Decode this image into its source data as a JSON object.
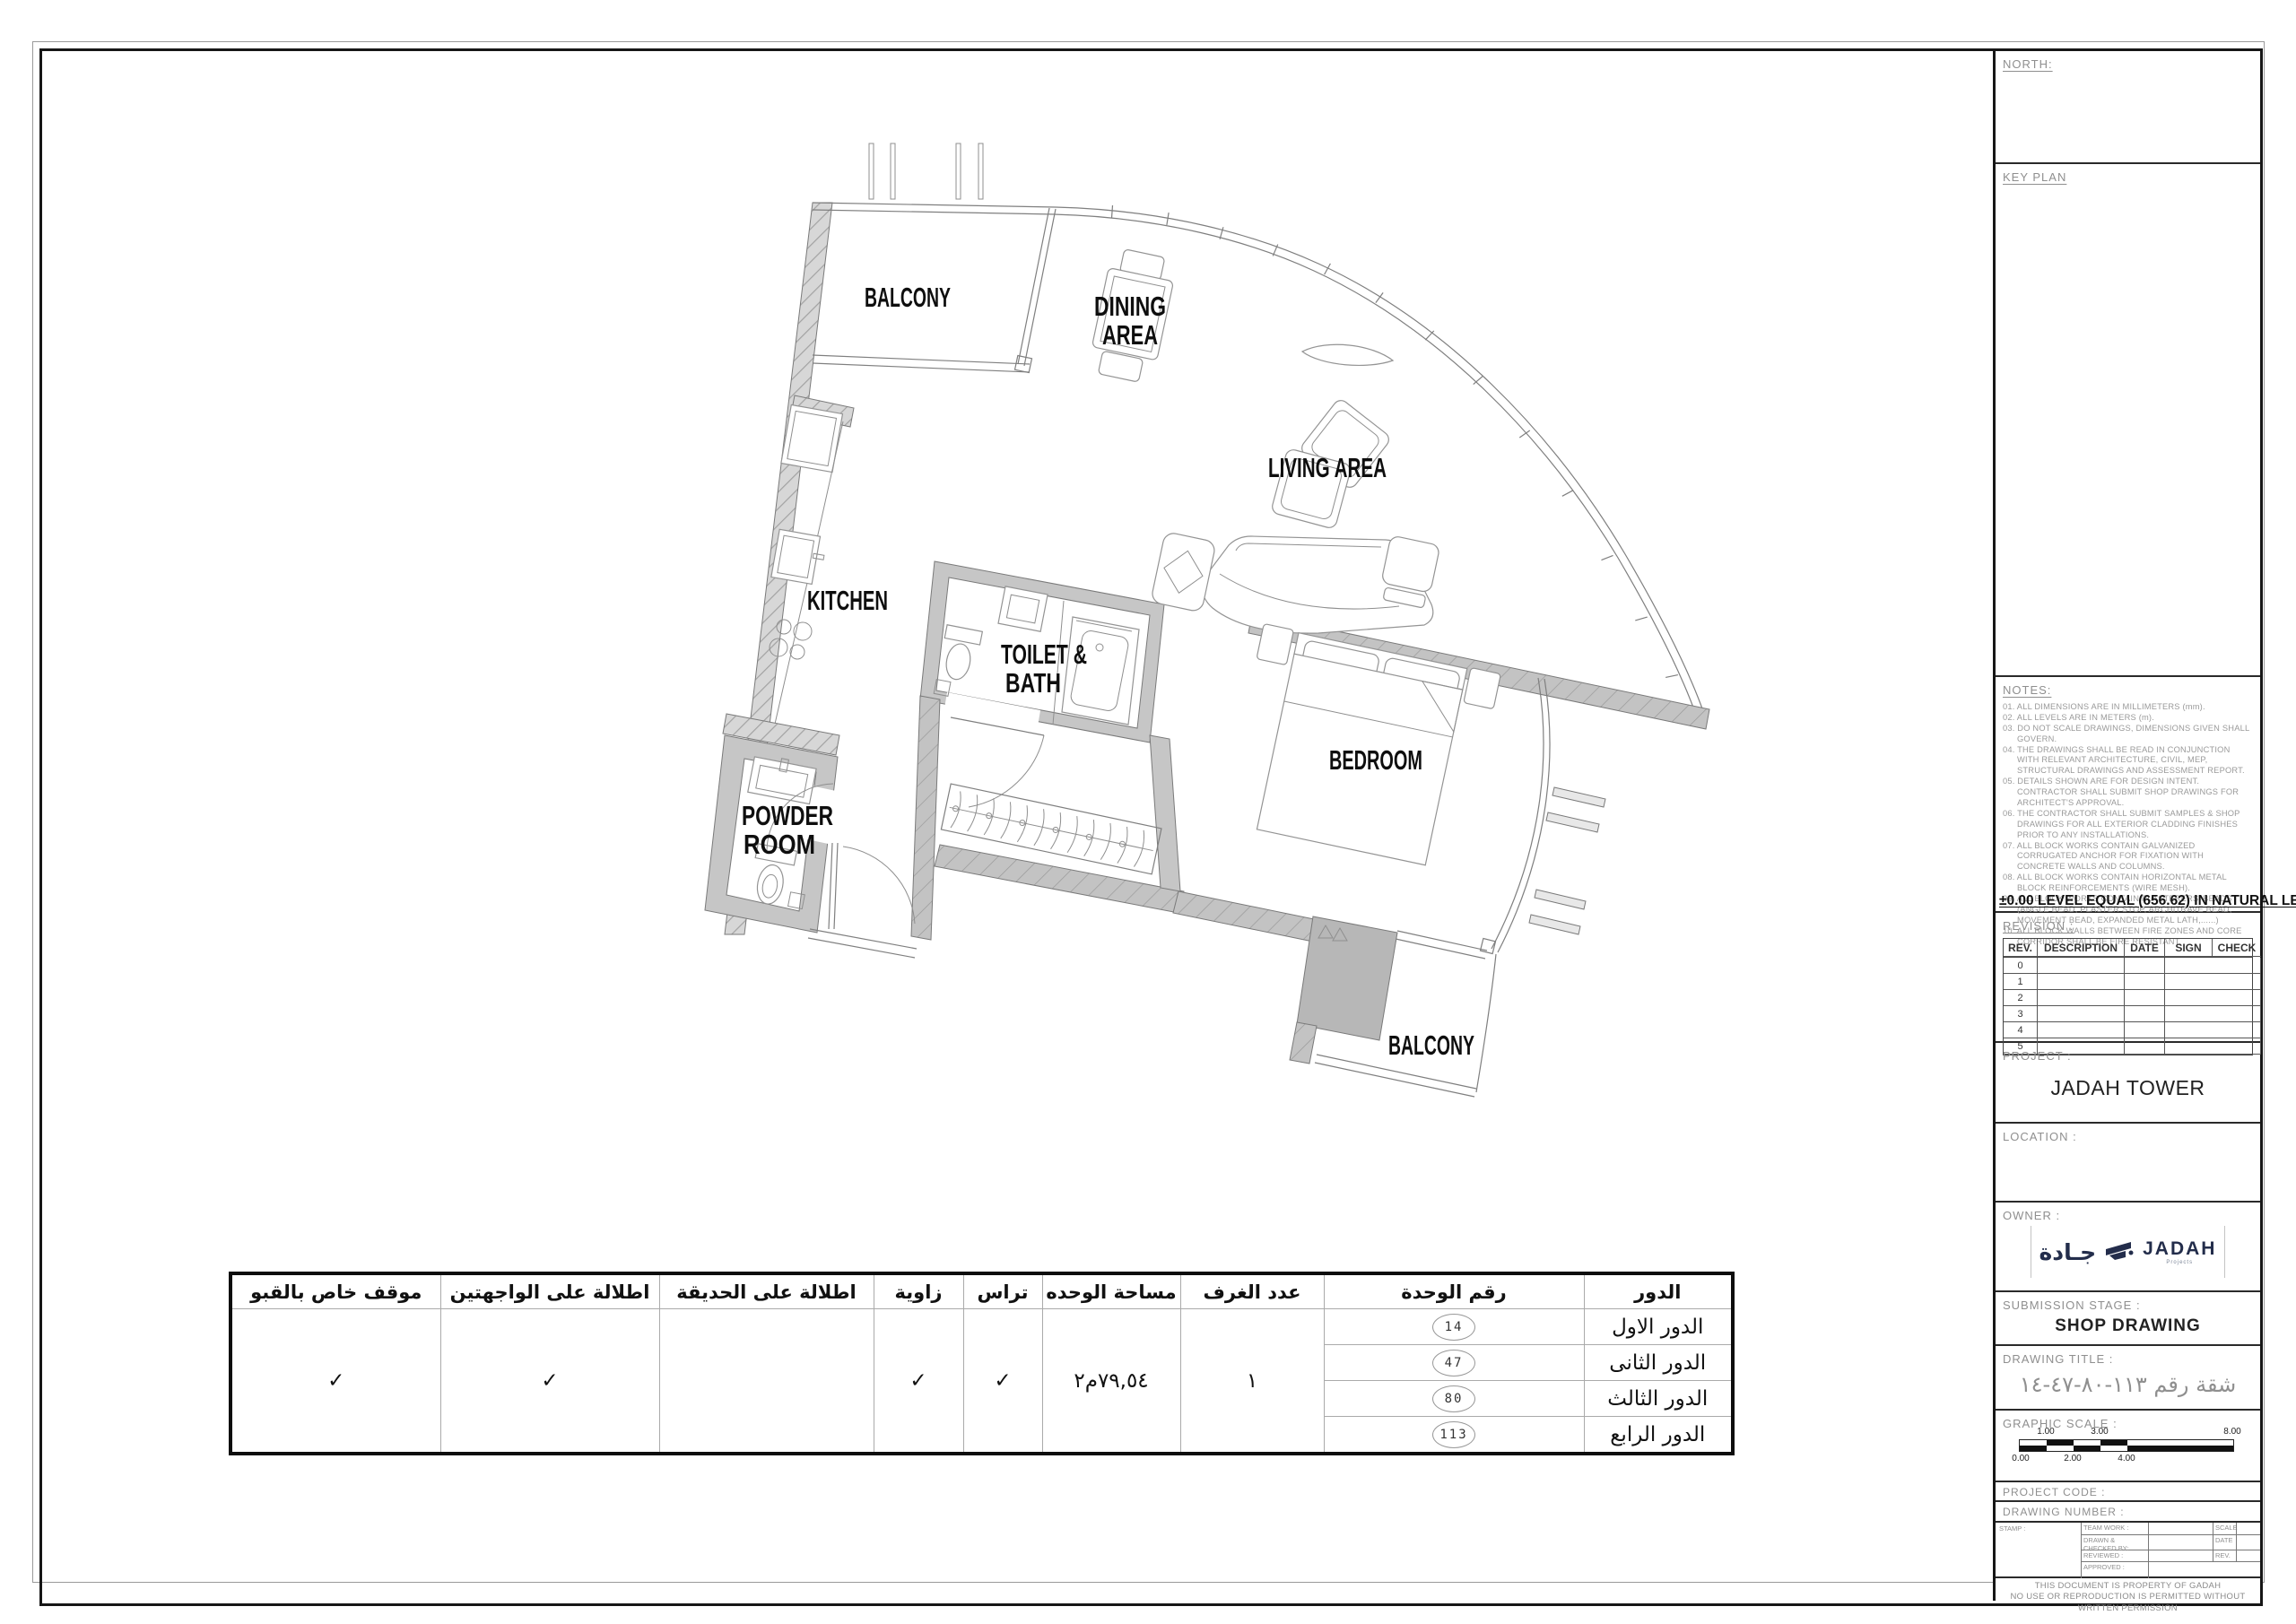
{
  "plan": {
    "labels": {
      "balcony_top": "BALCONY",
      "dining_1": "DINING",
      "dining_2": "AREA",
      "living": "LIVING AREA",
      "kitchen": "KITCHEN",
      "toilet_1": "TOILET &",
      "toilet_2": "BATH",
      "bedroom": "BEDROOM",
      "powder_1": "POWDER",
      "powder_2": "ROOM",
      "balcony_bottom": "BALCONY"
    }
  },
  "unit_table": {
    "headers": {
      "floor": "الدور",
      "unit_no": "رقم الوحدة",
      "rooms": "عدد الغرف",
      "area": "مساحة الوحده",
      "terrace": "تراس",
      "corner": "زاوية",
      "garden_view": "اطلالة على الحديقة",
      "two_facade_view": "اطلالة على الواجهتين",
      "basement_parking": "موقف خاص بالقبو"
    },
    "floors": [
      {
        "name": "الدور الاول",
        "unit": "14"
      },
      {
        "name": "الدور الثانى",
        "unit": "47"
      },
      {
        "name": "الدور الثالث",
        "unit": "80"
      },
      {
        "name": "الدور الرابع",
        "unit": "113"
      }
    ],
    "rooms_count": "١",
    "area_value": "٧٩,٥٤م٢",
    "terrace_check": "✓",
    "corner_check": "✓",
    "garden_check": "",
    "two_facade_check": "✓",
    "basement_check": "✓"
  },
  "titleblock": {
    "north_label": "NORTH:",
    "keyplan_label": "KEY PLAN",
    "notes_label": "NOTES:",
    "notes": [
      "01. ALL DIMENSIONS ARE IN MILLIMETERS (mm).",
      "02. ALL LEVELS ARE IN METERS (m).",
      "03. DO NOT SCALE DRAWINGS, DIMENSIONS GIVEN SHALL GOVERN.",
      "04. THE DRAWINGS SHALL BE READ IN CONJUNCTION WITH RELEVANT ARCHITECTURE, CIVIL, MEP, STRUCTURAL DRAWINGS AND ASSESSMENT REPORT.",
      "05. DETAILS SHOWN ARE FOR DESIGN INTENT. CONTRACTOR SHALL SUBMIT SHOP DRAWINGS FOR ARCHITECT'S APPROVAL.",
      "06. THE CONTRACTOR  SHALL SUBMIT SAMPLES & SHOP DRAWINGS FOR ALL EXTERIOR CLADDING FINISHES PRIOR TO ANY INSTALLATIONS.",
      "07. ALL BLOCK WORKS CONTAIN GALVANIZED CORRUGATED ANCHOR FOR FIXATION WITH CONCRETE WALLS AND COLUMNS.",
      "08. ALL BLOCK WORKS CONTAIN HORIZONTAL METAL BLOCK REINFORCEMENTS (WIRE MESH).",
      "09. ALL BLOCK WORKS CONTAIN PLASTERERS' BEADS (ANGLE BEAD, PLASTER STOP, ARCHITRAVE BEAD, MOVEMENT BEAD, EXPANDED METAL LATH,......)",
      "10. ALL BLOCK WALLS BETWEEN FIRE ZONES AND CORE CORRIDOR SHALL BE FIRE RESISTANT."
    ],
    "level_note": "±0.00 LEVEL EQUAL (656.62) IN NATURAL LEVEL",
    "revision_label": "REVISION :",
    "revision_headers": [
      "REV.",
      "DESCRIPTION",
      "DATE",
      "SIGN",
      "CHECK"
    ],
    "revision_rows": [
      "0",
      "1",
      "2",
      "3",
      "4",
      "5"
    ],
    "project_label": "PROJECT :",
    "project_name": "JADAH TOWER",
    "location_label": "LOCATION :",
    "owner_label": "OWNER :",
    "logo": {
      "arabic": "جـادة",
      "latin": "JADAH",
      "sub_latin": "Projects"
    },
    "submission_label": "SUBMISSION STAGE :",
    "submission_value": "SHOP DRAWING",
    "drawing_title_label": "DRAWING TITLE :",
    "drawing_title_value": "شقة رقم ١١٣-٨٠-٤٧-١٤",
    "scale_label": "GRAPHIC SCALE :",
    "scale_top_labels": [
      "1.00",
      "3.00",
      "8.00"
    ],
    "scale_bottom_labels": [
      "0.00",
      "2.00",
      "4.00"
    ],
    "project_code_label": "PROJECT CODE :",
    "drawing_number_label": "DRAWING NUMBER :",
    "stamp_label": "STAMP :",
    "stamp_team_label": "TEAM WORK :",
    "stamp_drawn_label": "DRAWN & CHECKED BY:",
    "stamp_reviewed_label": "REVIEWED :",
    "stamp_approved_label": "APPROVED :",
    "stamp_scale_label": "SCALE",
    "stamp_date_label": "DATE",
    "stamp_rev_label": "REV.",
    "disclaimer_1": "THIS DOCUMENT IS PROPERTY OF GADAH",
    "disclaimer_2": "NO USE OR REPRODUCTION IS PERMITTED WITHOUT WRITTEN PERMISSION"
  }
}
